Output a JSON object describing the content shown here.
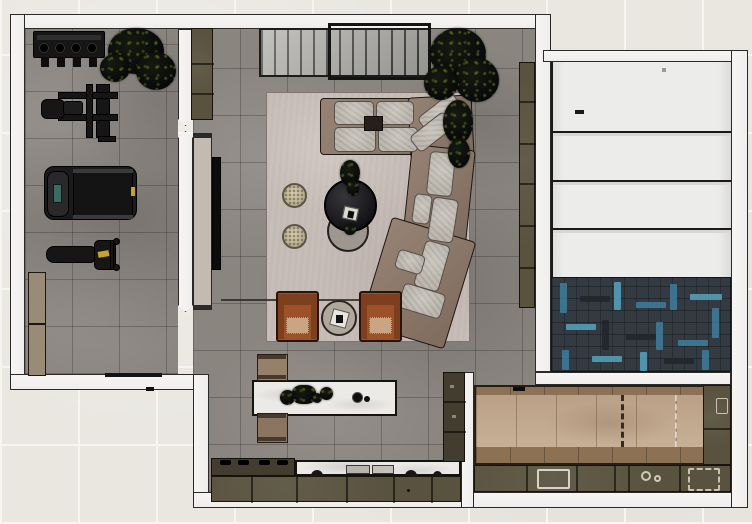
{
  "app": {
    "title": "3D interior floor plan – top-down section view"
  },
  "palette": {
    "bg": "#eae7e1",
    "grid": "#f7f5f1",
    "wall": "#efeeec",
    "wallEdge": "#2a2a28",
    "floorGray": "#8b8580",
    "tile": "rgba(40,38,34,0.30)",
    "rug": "#c8beb8",
    "slat": "#a9a8a3",
    "slatLine": "#3b3b39",
    "olive": "#59523f",
    "oliveDark": "#433d2f",
    "tanPanel": "#c3bab0",
    "sofaFrame": "#8d7868",
    "cushion": "#bdb8af",
    "chair": "#9c5129",
    "chairDark": "#7e3f1f",
    "chairSeat": "#c9a584",
    "tableDark": "#1e1e22",
    "tableGray": "#9d978e",
    "marble": "#eceae6",
    "stool": "#95816a",
    "wood": "#c3a98e",
    "woodDark": "#8d7155",
    "herrBase": "#333a41",
    "herrTeal": "#3f7e9c",
    "herrTeal2": "#58a3c0",
    "herrDark": "#20262c",
    "panel": "#ececeb",
    "equip": "#161616",
    "yellow": "#c9a227",
    "screen": "#3d6b63"
  },
  "rooms": {
    "gym": "Home gym",
    "living": "Living room",
    "kitchen": "Kitchen",
    "garage": "Garage",
    "games": "Bar / games room"
  },
  "furniture": {
    "gym": {
      "rack": "Dumbbell rack",
      "plant": "Potted plant",
      "machine": "Weight machine",
      "treadmill": "Treadmill",
      "bench": "Workout bench",
      "cabinet": "Storage cabinet"
    },
    "living": {
      "console": "Slatted media console",
      "fireplace": "Fireplace frame",
      "plant": "Tall plant",
      "rug": "Area rug",
      "sofa": "Sectional sofa",
      "coffeeDark": "Round coffee table",
      "coffeeGray": "Nesting coffee table",
      "pouf": "Round pouf",
      "armchair": "Leather armchair",
      "sideTable": "Side table",
      "tv": "Wall-mounted TV",
      "doorPanel": "Sliding door panel",
      "shelf": "Wall shelf unit"
    },
    "kitchen": {
      "island": "Kitchen island",
      "decor": "Island decor",
      "stool": "Island bench",
      "cooktop": "Cooktop counter",
      "sinkCounter": "Sink counter",
      "cabinets": "Base cabinets",
      "pantry": "Tall pantry cabinet"
    },
    "garage": {
      "panels": "Sectioned floor panels",
      "mat": "Herringbone mat"
    },
    "games": {
      "floor": "Wood plank floor",
      "counter": "Bar counter",
      "sink": "Bar sink",
      "burners": "Burner hob",
      "grill": "Grill tray"
    }
  }
}
